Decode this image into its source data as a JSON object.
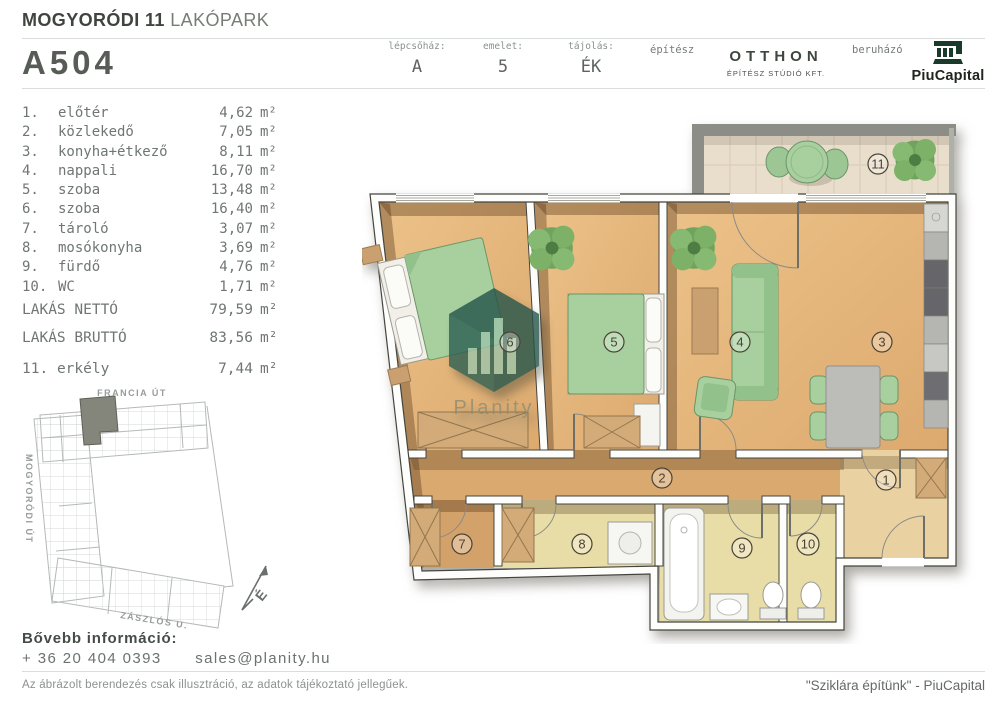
{
  "header": {
    "project_bold": "MOGYORÓDI 11",
    "project_light": "LAKÓPARK",
    "unit_id": "A504",
    "meta": [
      {
        "label": "lépcsőház:",
        "value": "A"
      },
      {
        "label": "emelet:",
        "value": "5"
      },
      {
        "label": "tájolás:",
        "value": "ÉK"
      }
    ],
    "architect_label": "építész",
    "architect_name": "OTTHON",
    "architect_sub": "ÉPÍTÉSZ STÚDIÓ KFT.",
    "developer_label": "beruházó",
    "developer_name": "PiuCapital"
  },
  "area_unit": "m²",
  "rooms": [
    {
      "num": "1.",
      "name": "előtér",
      "area": "4,62"
    },
    {
      "num": "2.",
      "name": "közlekedő",
      "area": "7,05"
    },
    {
      "num": "3.",
      "name": "konyha+étkező",
      "area": "8,11"
    },
    {
      "num": "4.",
      "name": "nappali",
      "area": "16,70"
    },
    {
      "num": "5.",
      "name": "szoba",
      "area": "13,48"
    },
    {
      "num": "6.",
      "name": "szoba",
      "area": "16,40"
    },
    {
      "num": "7.",
      "name": "tároló",
      "area": "3,07"
    },
    {
      "num": "8.",
      "name": "mosókonyha",
      "area": "3,69"
    },
    {
      "num": "9.",
      "name": "fürdő",
      "area": "4,76"
    },
    {
      "num": "10.",
      "name": "WC",
      "area": "1,71"
    }
  ],
  "totals": [
    {
      "label": "LAKÁS NETTÓ",
      "area": "79,59"
    },
    {
      "label": "LAKÁS BRUTTÓ",
      "area": "83,56"
    }
  ],
  "balcony_row": {
    "num": "11.",
    "name": "erkély",
    "area": "7,44"
  },
  "map": {
    "street_top": "FRANCIA ÚT",
    "street_left": "MOGYORÓDI ÚT",
    "street_bottom": "ZÁSZLÓS U.",
    "north": "É"
  },
  "plan_labels": [
    "1",
    "2",
    "3",
    "4",
    "5",
    "6",
    "7",
    "8",
    "9",
    "10",
    "11"
  ],
  "watermark": "Planity",
  "contact": {
    "heading": "Bővebb információ:",
    "phone": "+ 36 20 404 0393",
    "email": "sales@planity.hu"
  },
  "footer": {
    "disclaimer": "Az ábrázolt berendezés csak illusztráció, az adatok tájékoztató jellegűek.",
    "quote": "\"Sziklára építünk\" - PiuCapital"
  },
  "colors": {
    "wood_floor": "#e2b177",
    "bath_floor": "#e8dda6",
    "balcony_tile": "#e9decb",
    "furniture_green": "#a7d09e",
    "brand_green": "#1b3b2a",
    "map_highlight": "#85867b",
    "text_gray": "#6f7674"
  }
}
